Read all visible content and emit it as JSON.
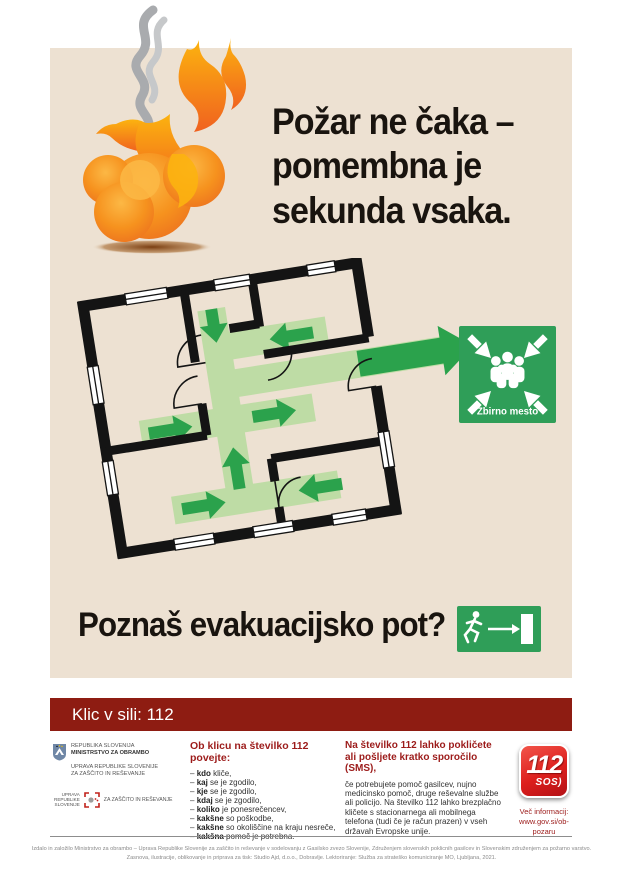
{
  "colors": {
    "panel_beige": "#ede1d2",
    "dark_red_bar": "#8e1c12",
    "heading_red": "#9c1b1a",
    "sign_green": "#2f9e58",
    "path_green": "#bedca5",
    "arrow_green": "#2ba24c",
    "flame_orange": "#f6921e",
    "logo_red": "#dd1f1d"
  },
  "hero": {
    "headline": "Požar ne čaka –\npomembna je\nsekunda vsaka."
  },
  "plan": {
    "assembly_sign_label": "Zbirno mesto"
  },
  "question": {
    "text": "Poznaš evakuacijsko pot?"
  },
  "emergency_bar": {
    "label": "Klic v sili: 112"
  },
  "footer": {
    "gov": {
      "line1": "REPUBLIKA SLOVENIJA",
      "line2": "MINISTRSTVO ZA OBRAMBO",
      "line3": "UPRAVA REPUBLIKE SLOVENIJE",
      "line4": "ZA ZAŠČITO IN REŠEVANJE",
      "badge_stack": "UPRAVA\nREPUBLIKE\nSLOVENIJE",
      "badge_label": "ZA ZAŠČITO IN REŠEVANJE"
    },
    "call": {
      "heading": "Ob klicu na številko 112 povejte:",
      "bullet": "–",
      "items": [
        {
          "bold": "kdo",
          "rest": " kliče,"
        },
        {
          "bold": "kaj",
          "rest": " se je zgodilo,"
        },
        {
          "bold": "kje",
          "rest": " se je zgodilo,"
        },
        {
          "bold": "kdaj",
          "rest": " se je zgodilo,"
        },
        {
          "bold": "koliko",
          "rest": " je ponesrečencev,"
        },
        {
          "bold": "kakšne",
          "rest": " so poškodbe,"
        },
        {
          "bold": "kakšne",
          "rest": " so okoliščine na kraju nesreče,"
        },
        {
          "bold": "kakšna",
          "rest": " pomoč je potrebna."
        }
      ]
    },
    "sms": {
      "heading": "Na številko 112 lahko pokličete ali pošljete kratko sporočilo (SMS),",
      "body": "če potrebujete pomoč gasilcev, nujno medicinsko pomoč, druge reševalne službe ali policijo. Na številko 112 lahko brezplačno kličete s stacionarnega ali mobilnega telefona (tudi če je račun prazen) v vseh državah Evropske unije."
    },
    "logo112": {
      "number": "112",
      "sos": "SOS)"
    },
    "info": {
      "label": "Več informacij:",
      "url": "www.gov.si/ob-pozaru"
    },
    "fine_print": {
      "line1": "Izdalo in založilo Ministrstvo za obrambo – Uprava Republike Slovenije za zaščito in reševanje v sodelovanju z Gasilsko zvezo Slovenije, Združenjem slovenskih poklicnih gasilcev in Slovenskim združenjem za požarno varstvo.",
      "line2": "Zasnova, ilustracije, oblikovanje in priprava za tisk: Studio Ajd, d.o.o., Dobravlje. Lektoriranje: Služba za strateško komuniciranje MO, Ljubljana, 2021."
    }
  }
}
